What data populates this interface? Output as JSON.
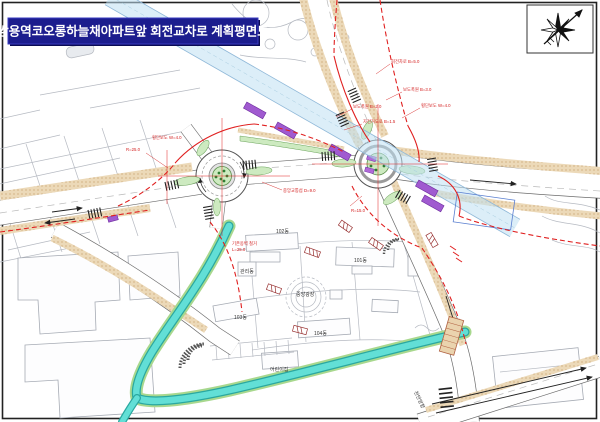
{
  "title": "쌍용역코오롱하늘채아파트앞 회전교차로 계획평면도",
  "map": {
    "buildings": {
      "b101": "101동",
      "b102": "102동",
      "b103": "103동",
      "b104": "104동",
      "mgmt": "관리동",
      "plaza": "중앙광장",
      "daycare": "어린이집"
    },
    "direction_label": "천안방향",
    "annotations": [
      {
        "text": "R=25.0"
      },
      {
        "text": "횡단보도 W=4.0"
      },
      {
        "text": "보도폭원 B=2.0"
      },
      {
        "text": "자전거도로 B=1.5"
      },
      {
        "text": "보도폭원 B=3.0"
      },
      {
        "text": "횡단보도 W=4.0"
      },
      {
        "text": "중앙교통섬 D=9.0"
      },
      {
        "text": "R=15.0"
      },
      {
        "text": "기존옹벽 철거"
      },
      {
        "text": "L=25.0"
      },
      {
        "text": "회전차로 B=5.0"
      }
    ],
    "colors": {
      "title_navy": "#1c1d8e",
      "boundary_red": "#e02020",
      "covered_channel_blue": "#d6ecf7",
      "open_stream_teal": "#4fd8cf",
      "sidewalk_tan": "#ecd9b8",
      "island_green": "#cdeac0",
      "bridge_purple": "#a05ad0"
    }
  }
}
